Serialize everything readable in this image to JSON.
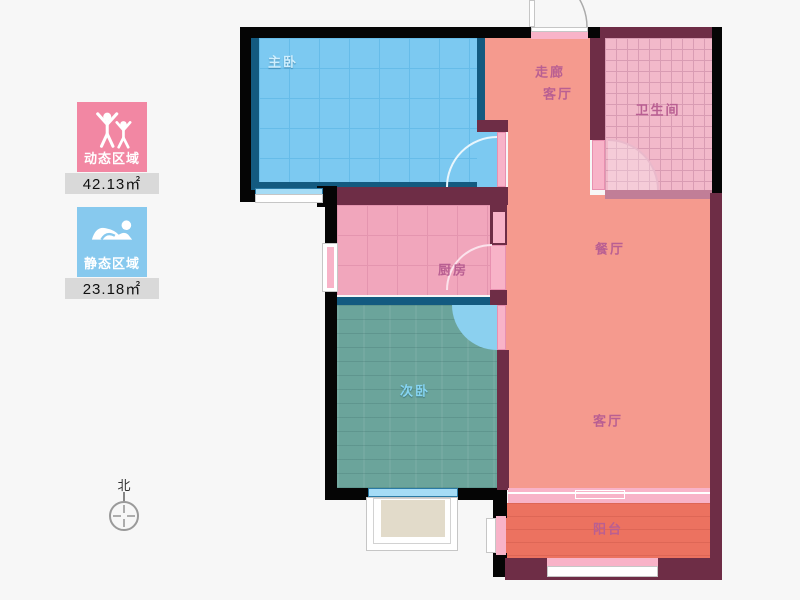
{
  "legend": {
    "items": [
      {
        "id": "dynamic-area",
        "label": "动态区域",
        "value": "42.13㎡",
        "color": "#f287a3",
        "icon": "standing-people-icon"
      },
      {
        "id": "static-area",
        "label": "静态区域",
        "value": "23.18㎡",
        "color": "#87c9ee",
        "icon": "sleeping-person-icon"
      }
    ]
  },
  "compass": {
    "label": "北"
  },
  "rooms": [
    {
      "id": "master-bedroom",
      "label": "主卧"
    },
    {
      "id": "hallway",
      "label": "走廊"
    },
    {
      "id": "living-upper",
      "label": "客厅"
    },
    {
      "id": "bathroom",
      "label": "卫生间"
    },
    {
      "id": "dining",
      "label": "餐厅"
    },
    {
      "id": "kitchen",
      "label": "厨房"
    },
    {
      "id": "second-bedroom",
      "label": "次卧"
    },
    {
      "id": "living-lower",
      "label": "客厅"
    },
    {
      "id": "balcony",
      "label": "阳台"
    }
  ],
  "colors": {
    "background": "#f7f7f7",
    "wall_black": "#050505",
    "wall_maroon": "#6e2d46",
    "master_bedroom_fill": "#7cc9f1",
    "master_bedroom_border": "#135a80",
    "open_area_fill": "#f59a8e",
    "kitchen_fill": "#f1a6bc",
    "bathroom_fill": "#f2b9ca",
    "second_bedroom_fill": "#6ba49b",
    "balcony_fill": "#ec7260",
    "window_pink": "#f8b3c8",
    "room_label": "#b95f92",
    "legend_value_bar": "#d9d9d9"
  }
}
